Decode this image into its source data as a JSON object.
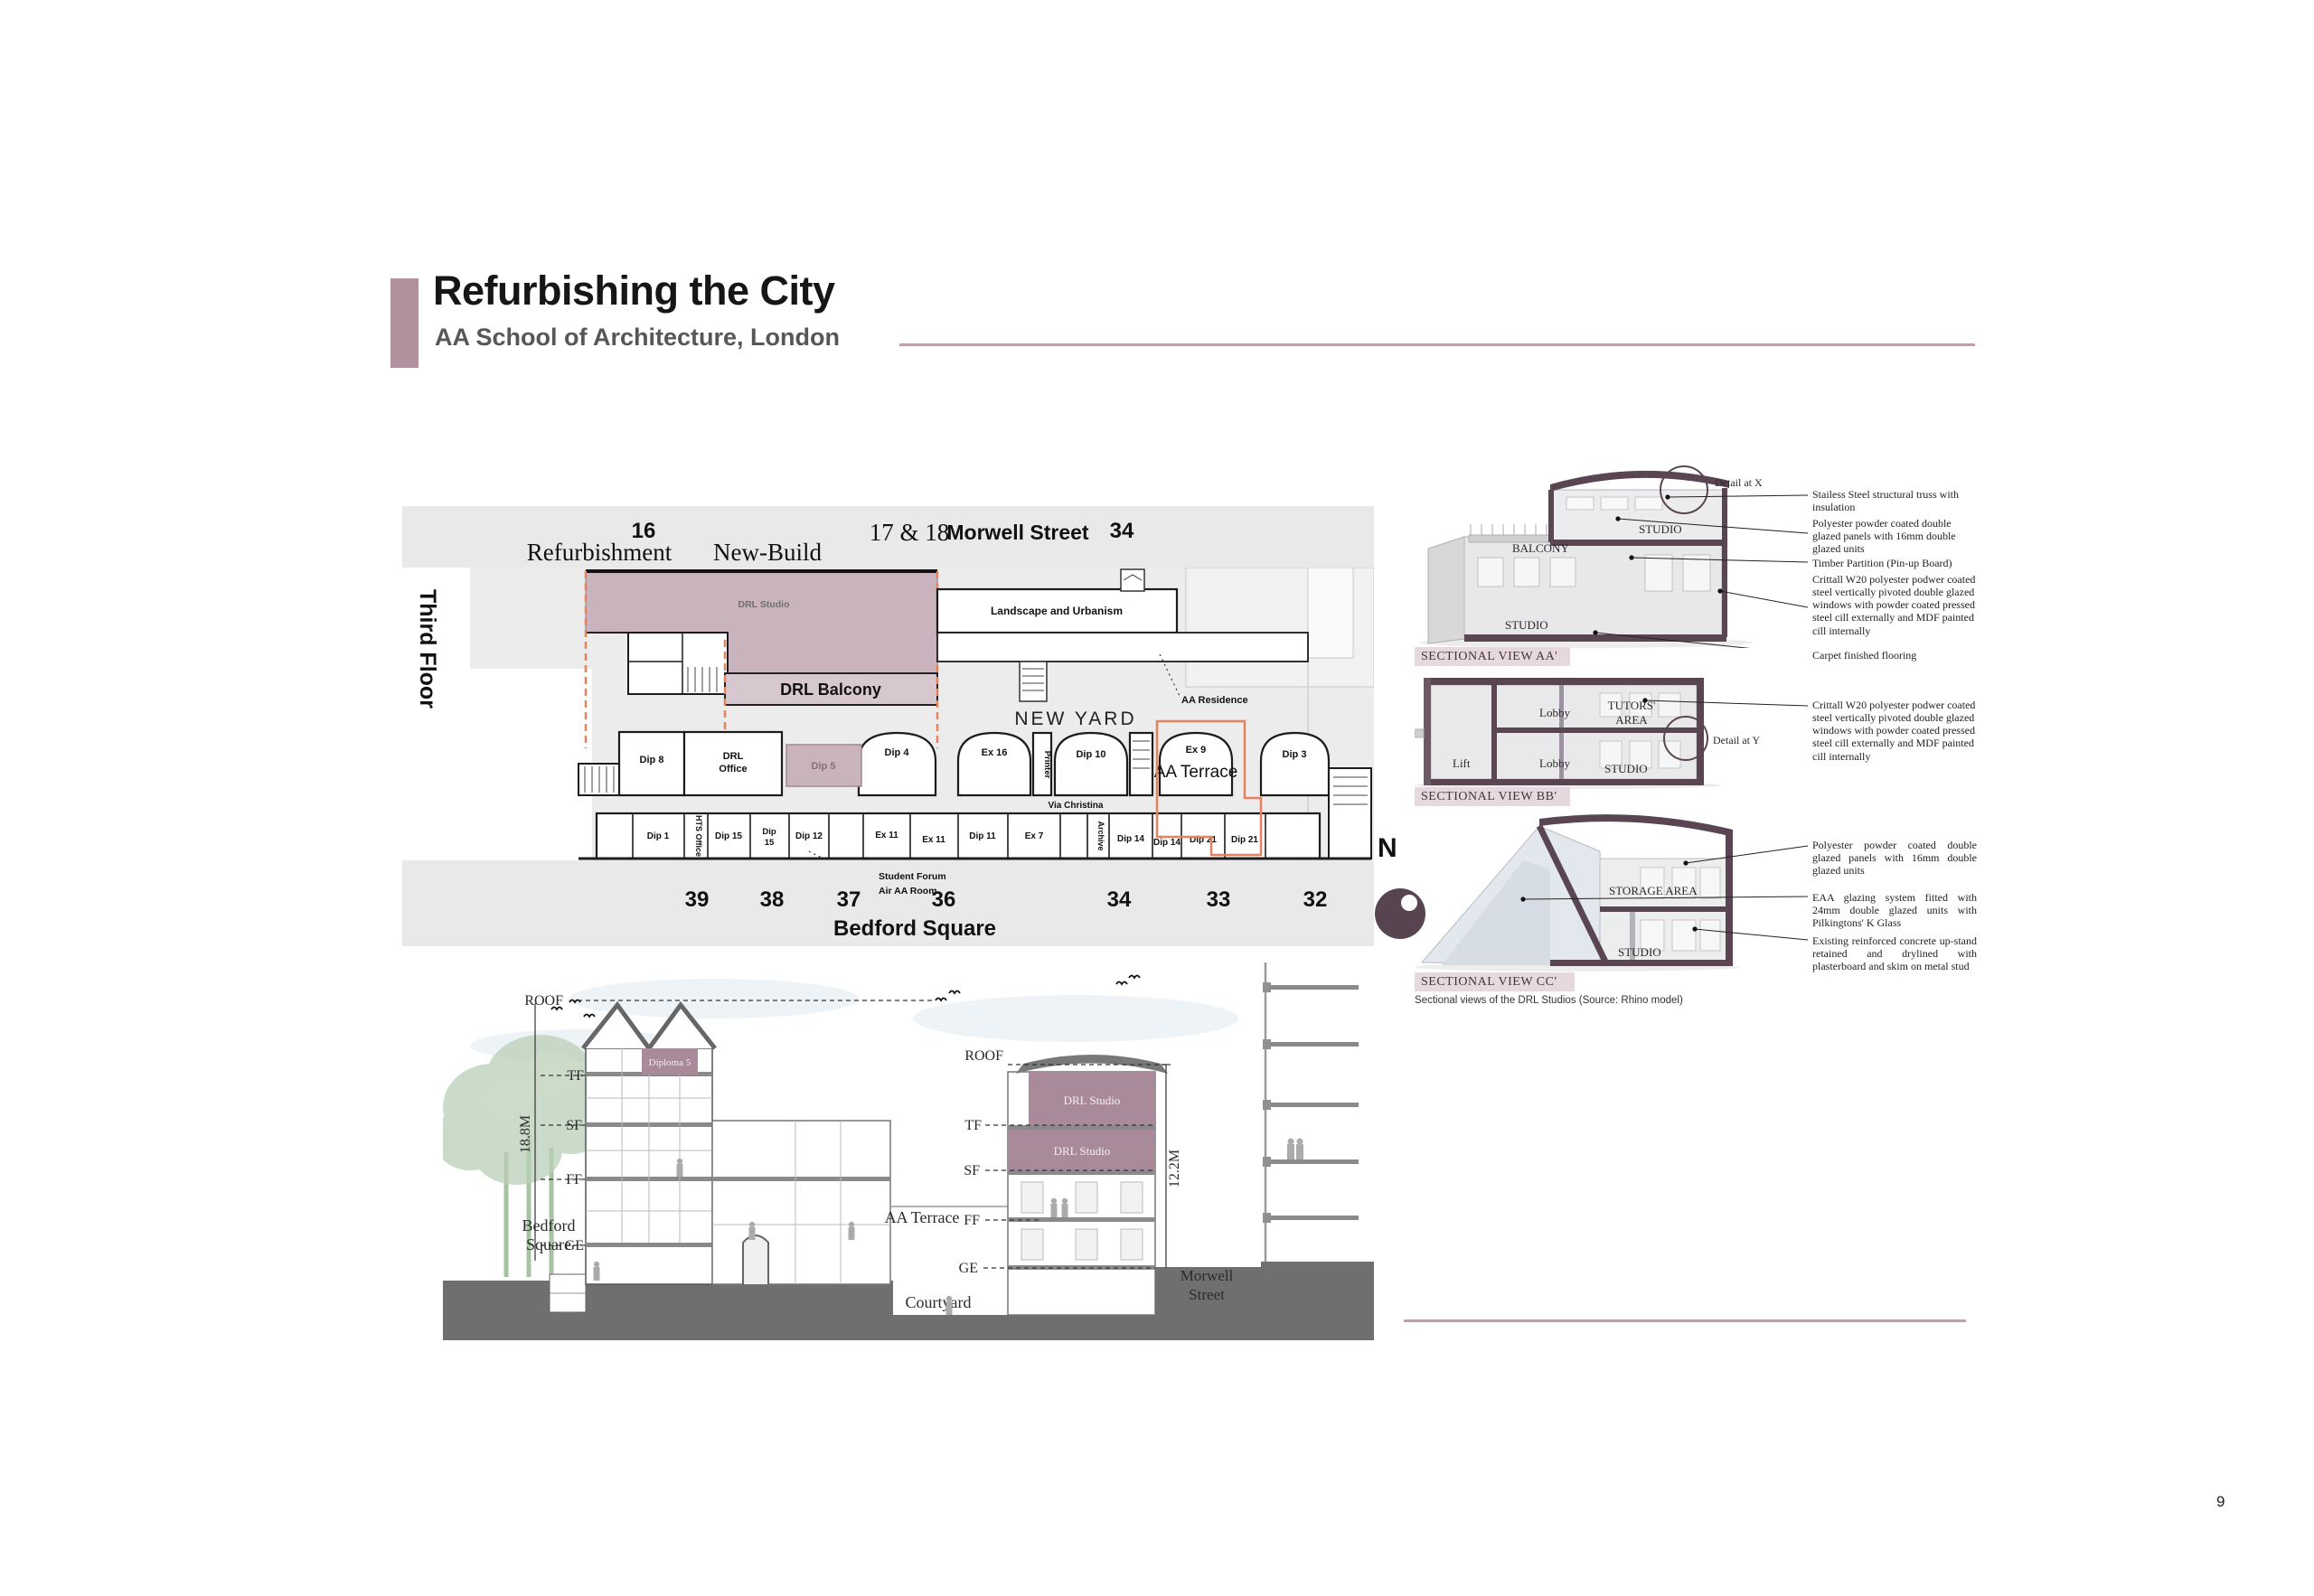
{
  "page_number": "9",
  "header": {
    "title": "Refurbishing the City",
    "subtitle": "AA School of Architecture, London"
  },
  "plan": {
    "side_label": "Third Floor",
    "top_band": {
      "left_number": "16",
      "refurbishment": "Refurbishment",
      "new_build": "New-Build",
      "mid_number": "17 & 18",
      "street": "Morwell Street",
      "right_number": "34"
    },
    "bottom_band": {
      "numbers": [
        "39",
        "38",
        "37",
        "36",
        "34",
        "33",
        "32"
      ],
      "street": "Bedford Square"
    },
    "rooms": {
      "drl_studio": "DRL Studio",
      "drl_balcony": "DRL Balcony",
      "landscape": "Landscape and Urbanism",
      "aa_residence": "AA Residence",
      "new_yard": "NEW YARD",
      "dip4": "Dip 4",
      "ex16": "Ex 16",
      "printer": "Printer",
      "dip10": "Dip 10",
      "ex9": "Ex 9",
      "aa_terrace": "AA Terrace",
      "dip3": "Dip 3",
      "via_christina": "Via Christina",
      "dip8": "Dip 8",
      "drl_office_1": "DRL",
      "drl_office_2": "Office",
      "dip5": "Dip 5",
      "dip1": "Dip 1",
      "hts_office": "HTS Office",
      "dip15a": "Dip 15",
      "dip15b_1": "Dip",
      "dip15b_2": "15",
      "dip12": "Dip 12",
      "ex11a": "Ex 11",
      "ex11b": "Ex 11",
      "dip11": "Dip 11",
      "ex7": "Ex 7",
      "archive": "Archive",
      "dip14a": "Dip 14",
      "dip14b": "Dip 14",
      "dip21a": "Dip 21",
      "dip21b": "Dip 21"
    },
    "callout_line1": "Student Forum",
    "callout_line2": "Air AA Room"
  },
  "sections": {
    "aa": {
      "caption": "SECTIONAL VIEW AA'",
      "detail_label": "Detail at X",
      "balcony": "BALCONY",
      "studio_upper": "STUDIO",
      "studio_lower": "STUDIO",
      "annotations": [
        "Stailess Steel structural truss with insulation",
        "Polyester powder coated double glazed panels with 16mm double glazed units",
        "Timber Partition (Pin-up Board)",
        "Crittall W20 polyester podwer coated steel vertically pivoted double glazed windows with powder coated pressed steel cill externally and MDF painted cill internally",
        "Carpet finished flooring"
      ]
    },
    "bb": {
      "caption": "SECTIONAL VIEW BB'",
      "detail_label": "Detail at Y",
      "lobby_upper": "Lobby",
      "tutors_1": "TUTORS'",
      "tutors_2": "AREA",
      "lift": "Lift",
      "lobby_lower": "Lobby",
      "studio": "STUDIO",
      "annotations": [
        "Crittall W20 polyester podwer coated steel vertically pivoted double glazed windows with powder coated pressed steel cill externally and MDF painted cill internally"
      ]
    },
    "cc": {
      "caption": "SECTIONAL VIEW CC'",
      "storage": "STORAGE AREA",
      "studio": "STUDIO",
      "annotations": [
        "Polyester powder coated double glazed panels with 16mm double glazed units",
        "EAA glazing system fitted with 24mm double glazed units with Pilkingtons' K Glass",
        "Existing reinforced concrete up-stand retained and drylined with plasterboard and skim on metal stud"
      ]
    },
    "note": "Sectional views of the DRL Studios (Source: Rhino model)",
    "compass_label": "N"
  },
  "section_drawing": {
    "dim_left": "18.8M",
    "dim_right": "12.2M",
    "floors_left": {
      "roof": "ROOF",
      "tf": "TF",
      "sf": "SF",
      "ff": "FF",
      "ge": "GE"
    },
    "floors_right": {
      "roof": "ROOF",
      "tf": "TF",
      "sf": "SF",
      "ff": "FF",
      "ge": "GE"
    },
    "bedford_1": "Bedford",
    "bedford_2": "Square",
    "aa_terrace": "AA Terrace",
    "courtyard": "Courtyard",
    "morwell_1": "Morwell",
    "morwell_2": "Street",
    "diploma5": "Diploma 5",
    "drl_studio_upper": "DRL Studio",
    "drl_studio_lower": "DRL Studio"
  },
  "colors": {
    "accent_mauve": "#b2919e",
    "cut_purple": "#5a4653",
    "plan_pink": "#c9b3bd",
    "balcony_pink": "#d7c8cf",
    "section_pink": "#a98a9b",
    "highlight_orange": "#e8825c",
    "caption_bg": "#e7d8dd"
  }
}
